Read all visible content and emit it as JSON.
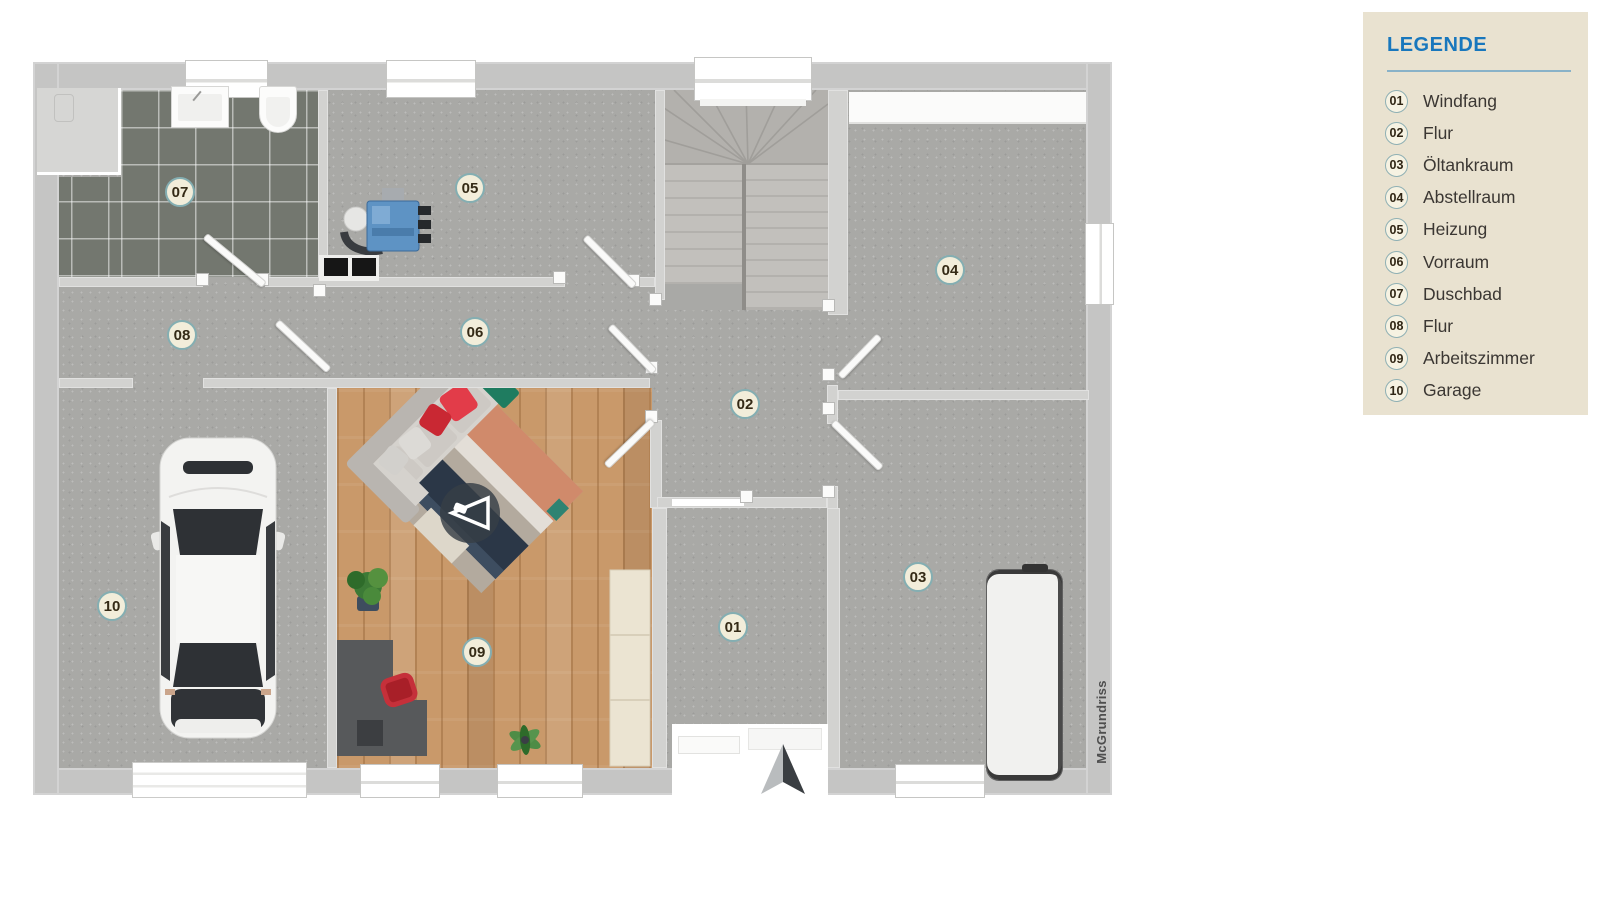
{
  "legend": {
    "title": "LEGENDE",
    "items": [
      {
        "num": "01",
        "label": "Windfang"
      },
      {
        "num": "02",
        "label": "Flur"
      },
      {
        "num": "03",
        "label": "Öltankraum"
      },
      {
        "num": "04",
        "label": "Abstellraum"
      },
      {
        "num": "05",
        "label": "Heizung"
      },
      {
        "num": "06",
        "label": "Vorraum"
      },
      {
        "num": "07",
        "label": "Duschbad"
      },
      {
        "num": "08",
        "label": "Flur"
      },
      {
        "num": "09",
        "label": "Arbeitszimmer"
      },
      {
        "num": "10",
        "label": "Garage"
      }
    ]
  },
  "plan": {
    "watermark": "McGrundriss"
  },
  "colors": {
    "accent_blue": "#1877bd",
    "legend_bg": "#e9e2d0",
    "badge_ring": "#84aeb2",
    "wall_gray": "#c5c5c4",
    "floor_gray": "#a9a9a6",
    "tile_dark": "#73776f",
    "wood": "#c9996a",
    "sofa_red": "#e23c49",
    "heater_blue": "#5e93c4",
    "north_arrow_dark": "#3a3e42"
  }
}
